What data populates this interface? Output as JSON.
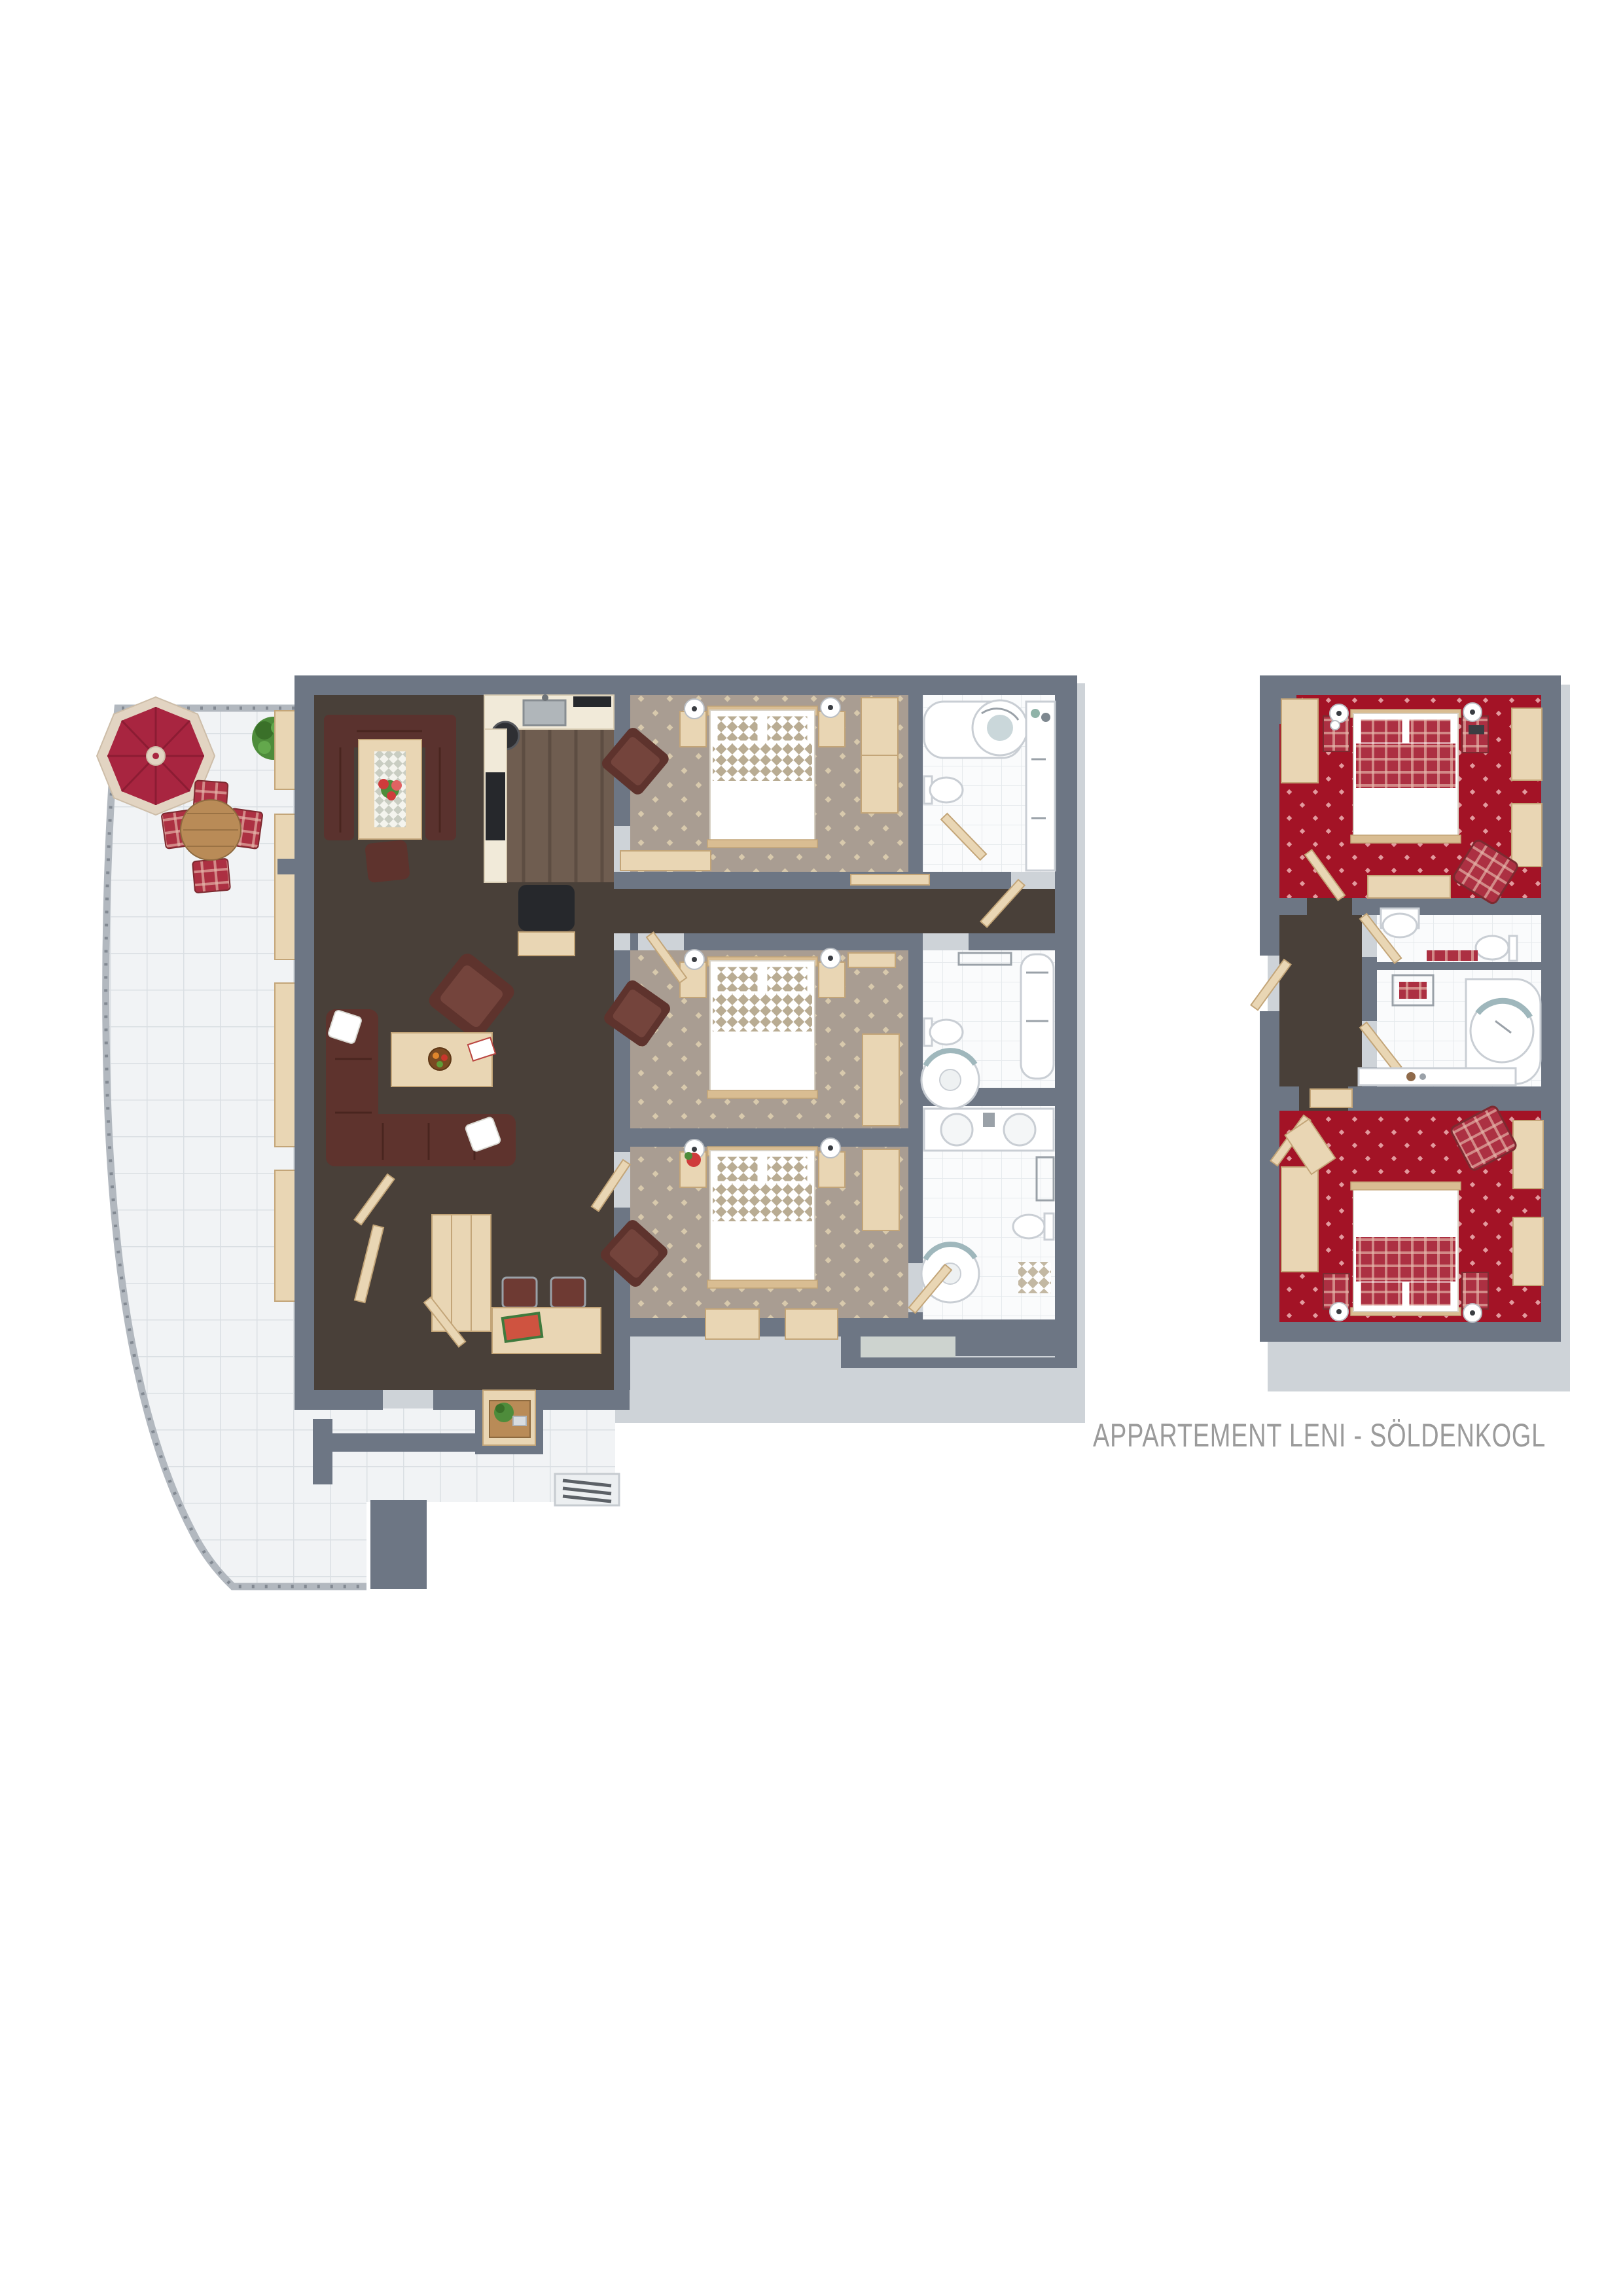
{
  "title": "APPARTEMENT LENI - SÖLDENKOGL",
  "plan_type": "3d-top-down-floor-plan",
  "colors": {
    "wall": "#6d7684",
    "skirt": "#ced3d8",
    "terraceTile": "#f1f3f5",
    "tileGrout": "#dadfe3",
    "bathTile": "#fafbfc",
    "bathGrout": "#e6eaed",
    "livingCarpet": "#494039",
    "bedroomCarpet": "#a99d92",
    "bedroomMotif": "#d8c9ac",
    "redCarpet": "#a31326",
    "redMotif": "#e29a9e",
    "kitchenFloor": "#6f5d50",
    "plankLine": "#5d4d42",
    "woodLight": "#e9d6b4",
    "woodEdge": "#c3a578",
    "woodMid": "#d9bd92",
    "tableWood": "#b98b57",
    "sofa": "#5e332d",
    "sofaLight": "#74443c",
    "benchBrown": "#5a322e",
    "duvetCheck": "#b9ac93",
    "plaidRed": "#ac3042",
    "plaidLine": "#e7b9ad",
    "umbrellaRed": "#a82540",
    "umbrellaTrim": "#e2d4c2",
    "plant": "#4e8c3b",
    "plantDark": "#3a7029",
    "fixture": "#c9ced4",
    "chrome": "#9aa1a8",
    "teal": "#9fb7bc",
    "cream": "#f1ead9",
    "black": "#26282c",
    "greenFloor": "#cdd3cf",
    "title": "#9b9b9b"
  },
  "units": [
    {
      "name": "main-apartment",
      "rooms": [
        {
          "name": "terrace",
          "floor": "white-tile",
          "furniture": [
            "red-parasol",
            "round-wooden-table",
            "four-red-plaid-chairs",
            "green-plant",
            "window-benches",
            "radiator-grille",
            "curved-railing",
            "parapet-walls"
          ]
        },
        {
          "name": "living-dining-room",
          "floor": "dark-brown-carpet",
          "furniture": [
            "corner-dining-bench",
            "dining-table-with-flower-runner",
            "dining-chair",
            "l-shaped-leather-sofa",
            "two-white-cushions",
            "coffee-table-with-fruit-bowl-and-magazine",
            "leather-armchair",
            "desk-with-magazines",
            "two-desk-chairs",
            "entry-wardrobe",
            "entry-doors",
            "niche-table-with-plant"
          ]
        },
        {
          "name": "kitchen",
          "floor": "dark-wood-planks",
          "furniture": [
            "counter-with-sink",
            "cooktop",
            "round-basket",
            "tall-appliance-cabinet",
            "black-stool",
            "low-cabinet"
          ]
        },
        {
          "name": "bedroom-1",
          "floor": "patterned-taupe-carpet",
          "furniture": [
            "double-bed-checkered-duvet",
            "two-nightstands",
            "two-table-lamps",
            "brown-armchair",
            "wardrobe",
            "sideboard"
          ]
        },
        {
          "name": "hallway",
          "floor": "dark-brown-carpet",
          "furniture": [
            "door-to-bathroom-1"
          ]
        },
        {
          "name": "bedroom-2",
          "floor": "patterned-taupe-carpet",
          "furniture": [
            "double-bed-checkered-duvet",
            "two-nightstands",
            "two-table-lamps",
            "brown-armchair",
            "wardrobe",
            "wall-sideboard"
          ]
        },
        {
          "name": "bedroom-3",
          "floor": "patterned-taupe-carpet",
          "furniture": [
            "double-bed-checkered-duvet",
            "two-nightstands",
            "flower-vase",
            "two-table-lamps",
            "brown-armchair",
            "wardrobe",
            "two-window-benches"
          ]
        },
        {
          "name": "bathroom-1",
          "floor": "white-tile",
          "furniture": [
            "bathtub-with-whirlpool",
            "toilet",
            "counter-cabinets",
            "toiletries",
            "door"
          ]
        },
        {
          "name": "bathroom-2",
          "floor": "white-tile",
          "furniture": [
            "towel-rack",
            "toilet",
            "corner-shower",
            "bathtub",
            "door"
          ]
        },
        {
          "name": "bathroom-3",
          "floor": "white-tile",
          "furniture": [
            "double-sink-vanity",
            "towel-ladder",
            "toilet",
            "corner-shower",
            "bath-mat",
            "double-doors"
          ]
        }
      ]
    },
    {
      "name": "second-apartment",
      "rooms": [
        {
          "name": "bedroom-a",
          "floor": "patterned-red-carpet",
          "furniture": [
            "double-bed-red-plaid",
            "two-plaid-nightstands",
            "two-table-lamps",
            "wardrobe",
            "two-wall-cabinets",
            "desk",
            "red-plaid-armchair",
            "door"
          ]
        },
        {
          "name": "entry-corridor",
          "floor": "dark-brown-carpet",
          "furniture": [
            "entry-door",
            "inner-doors",
            "wooden-bench"
          ]
        },
        {
          "name": "wc",
          "floor": "white-tile",
          "furniture": [
            "washbasin",
            "toilet",
            "red-bath-mat"
          ]
        },
        {
          "name": "bathroom",
          "floor": "white-tile",
          "furniture": [
            "towel-rack-with-red-towels",
            "corner-bathtub-whirlpool",
            "vanity-counter",
            "toiletries"
          ]
        },
        {
          "name": "bedroom-b",
          "floor": "patterned-red-carpet",
          "furniture": [
            "double-bed-red-plaid",
            "two-plaid-nightstands",
            "two-table-lamps",
            "wardrobe",
            "two-wall-cabinets",
            "red-plaid-armchair",
            "door"
          ]
        }
      ]
    }
  ]
}
